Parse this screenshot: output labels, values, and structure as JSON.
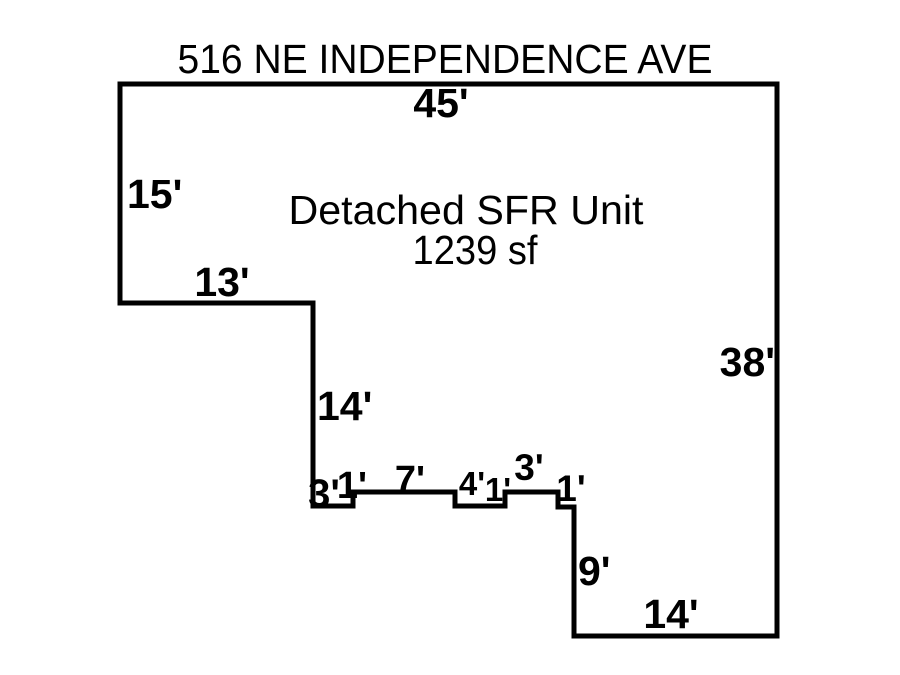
{
  "sketch": {
    "title": "516 NE INDEPENDENCE AVE",
    "unit_name": "Detached SFR Unit",
    "unit_area": "1239 sf",
    "colors": {
      "line": "#000000",
      "text": "#000000",
      "background": "#ffffff"
    },
    "dimensions": {
      "top": "45'",
      "left_upper": "15'",
      "left_step": "13'",
      "mid_vertical": "14'",
      "right": "38'",
      "notch_1": "3'",
      "notch_2": "1'",
      "notch_3": "7'",
      "notch_4": "4'",
      "notch_5": "1'",
      "notch_6": "3'",
      "notch_7": "1'",
      "bottom_right_vertical": "9'",
      "bottom": "14'"
    }
  }
}
